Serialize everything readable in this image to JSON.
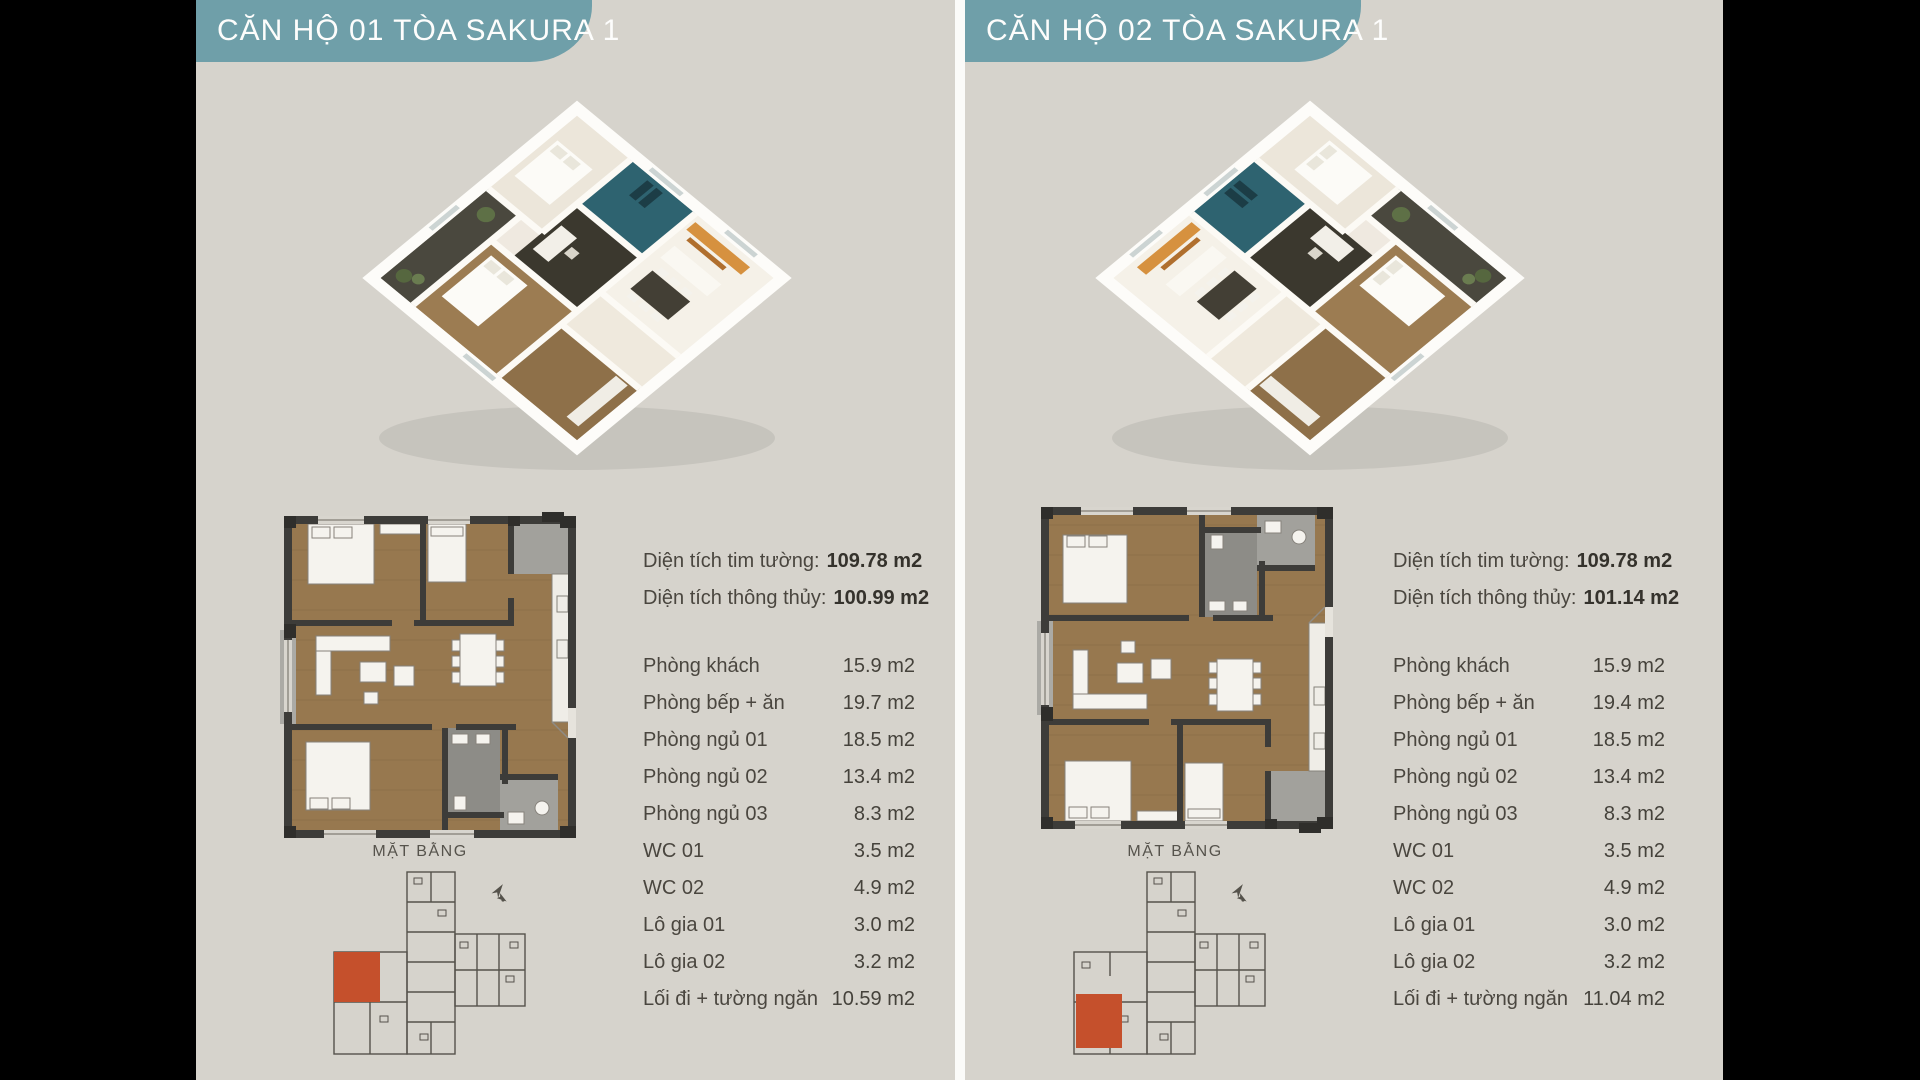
{
  "page": {
    "background_color": "#d6d3cc",
    "accent_teal": "#6f9fa9",
    "highlight_red": "#c5502c",
    "wall_color": "#3d3c39",
    "wood_color": "#97784f"
  },
  "panels": [
    {
      "unit": "01",
      "header": "CĂN HỘ 01 TÒA SAKURA 1",
      "area_lines": [
        {
          "label": "Diện tích tim tường:",
          "value": "109.78 m2"
        },
        {
          "label": "Diện tích thông thủy:",
          "value": "100.99 m2"
        }
      ],
      "rooms": [
        {
          "label": "Phòng khách",
          "value": "15.9 m2"
        },
        {
          "label": "Phòng bếp + ăn",
          "value": "19.7 m2"
        },
        {
          "label": "Phòng ngủ 01",
          "value": "18.5 m2"
        },
        {
          "label": "Phòng ngủ 02",
          "value": "13.4 m2"
        },
        {
          "label": "Phòng ngủ 03",
          "value": "8.3 m2"
        },
        {
          "label": "WC 01",
          "value": "3.5 m2"
        },
        {
          "label": "WC 02",
          "value": "4.9 m2"
        },
        {
          "label": "Lô gia 01",
          "value": "3.0 m2"
        },
        {
          "label": "Lô gia 02",
          "value": "3.2 m2"
        },
        {
          "label": "Lối đi + tường ngăn",
          "value": "10.59 m2"
        }
      ],
      "plan_caption": "MẶT BẰNG",
      "keyplan_highlight": "middle-left"
    },
    {
      "unit": "02",
      "header": "CĂN HỘ 02 TÒA SAKURA 1",
      "area_lines": [
        {
          "label": "Diện tích tim tường:",
          "value": "109.78 m2"
        },
        {
          "label": "Diện tích thông thủy:",
          "value": "101.14 m2"
        }
      ],
      "rooms": [
        {
          "label": "Phòng khách",
          "value": "15.9 m2"
        },
        {
          "label": "Phòng bếp + ăn",
          "value": "19.4 m2"
        },
        {
          "label": "Phòng ngủ 01",
          "value": "18.5 m2"
        },
        {
          "label": "Phòng ngủ 02",
          "value": "13.4 m2"
        },
        {
          "label": "Phòng ngủ 03",
          "value": "8.3 m2"
        },
        {
          "label": "WC 01",
          "value": "3.5 m2"
        },
        {
          "label": "WC 02",
          "value": "4.9 m2"
        },
        {
          "label": "Lô gia 01",
          "value": "3.0 m2"
        },
        {
          "label": "Lô gia 02",
          "value": "3.2 m2"
        },
        {
          "label": "Lối đi + tường ngăn",
          "value": "11.04 m2"
        }
      ],
      "plan_caption": "MẶT BẰNG",
      "keyplan_highlight": "bottom-left"
    }
  ]
}
